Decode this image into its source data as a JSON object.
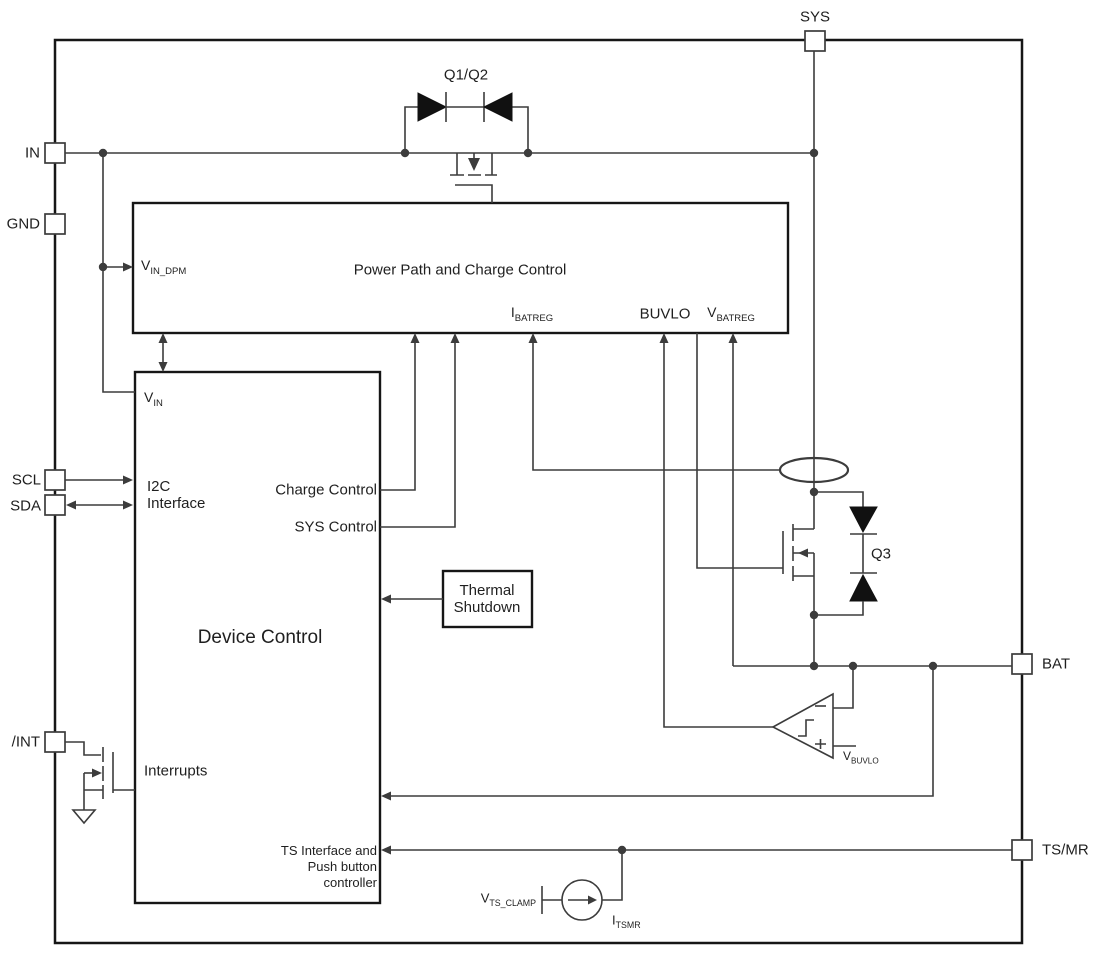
{
  "diagram_title": "Battery charger functional block diagram",
  "colors": {
    "line": "#3c3c3c",
    "block_border": "#161616",
    "text": "#1f1f1f",
    "background": "#ffffff"
  },
  "pins": {
    "sys": "SYS",
    "in": "IN",
    "gnd": "GND",
    "scl": "SCL",
    "sda": "SDA",
    "int": "/INT",
    "bat": "BAT",
    "tsmr": "TS/MR"
  },
  "blocks": {
    "power_path": {
      "title": "Power Path and Charge Control"
    },
    "device_control": {
      "title": "Device Control"
    },
    "thermal": {
      "line1": "Thermal",
      "line2": "Shutdown"
    }
  },
  "labels": {
    "q1q2": "Q1/Q2",
    "q3": "Q3",
    "vin_dpm": {
      "main": "V",
      "sub": "IN_DPM"
    },
    "ibatreg": {
      "main": "I",
      "sub": "BATREG"
    },
    "buvlo": "BUVLO",
    "vbatreg": {
      "main": "V",
      "sub": "BATREG"
    },
    "vin": {
      "main": "V",
      "sub": "IN"
    },
    "i2c_line1": "I2C",
    "i2c_line2": "Interface",
    "charge_control": "Charge Control",
    "sys_control": "SYS Control",
    "interrupts": "Interrupts",
    "ts_if_line1": "TS Interface and",
    "ts_if_line2": "Push button",
    "ts_if_line3": "controller",
    "vbuvlo": {
      "main": "V",
      "sub": "BUVLO"
    },
    "vts_clamp": {
      "main": "V",
      "sub": "TS_CLAMP"
    },
    "itsmr": {
      "main": "I",
      "sub": "TSMR"
    },
    "comparator_minus": "−",
    "comparator_plus": "+"
  }
}
